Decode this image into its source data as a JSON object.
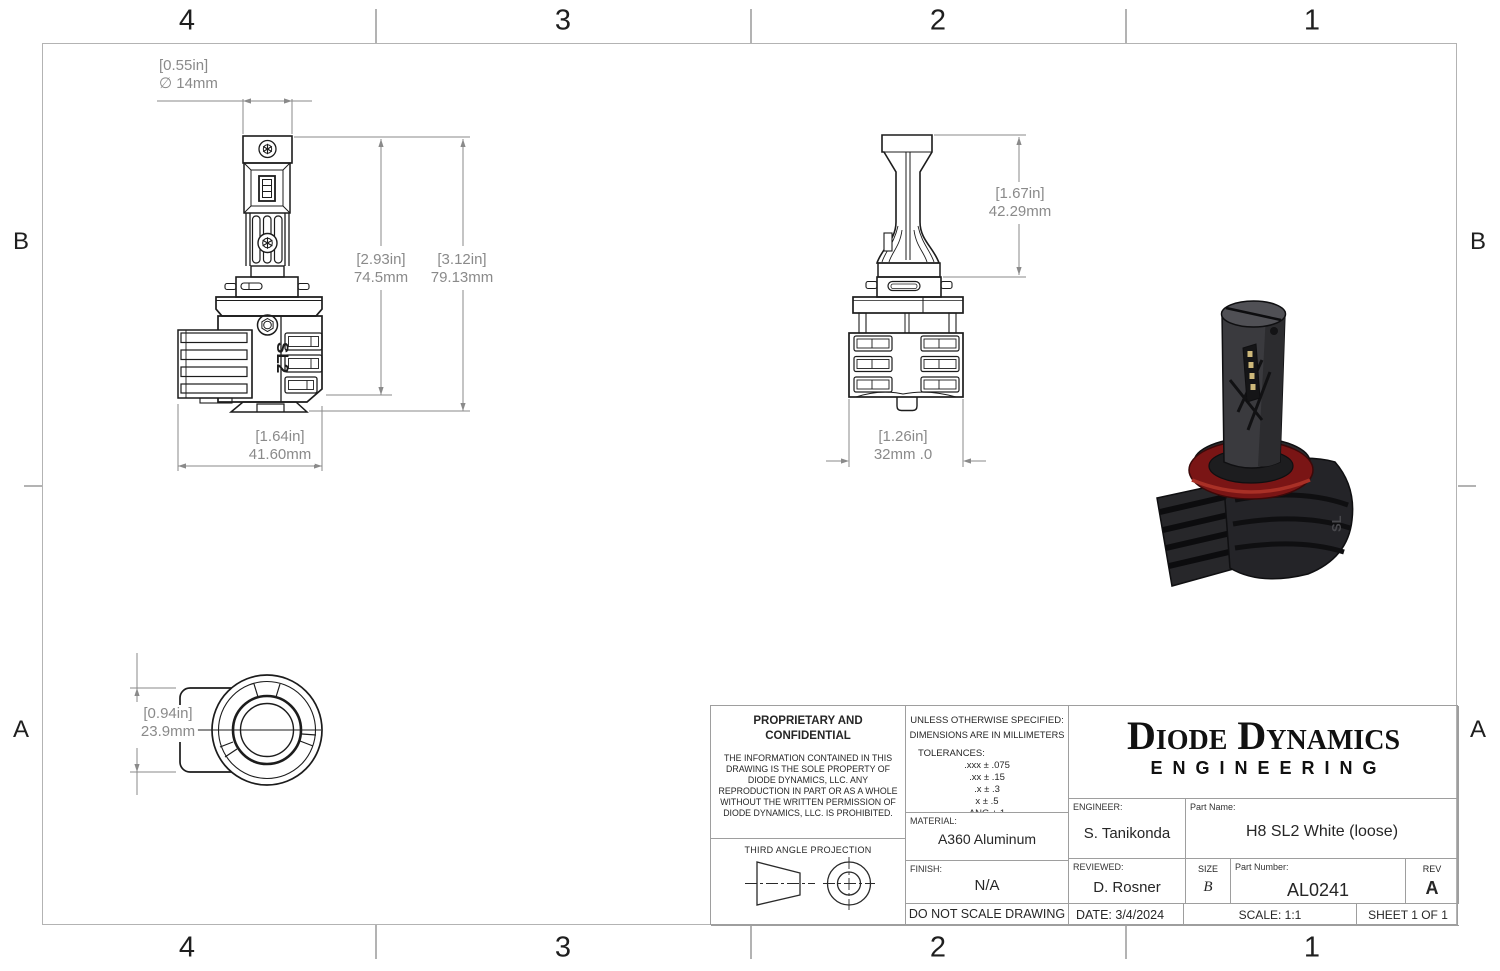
{
  "zones": {
    "top": [
      "4",
      "3",
      "2",
      "1"
    ],
    "bottom": [
      "4",
      "3",
      "2",
      "1"
    ],
    "left": [
      "B",
      "A"
    ],
    "right": [
      "B",
      "A"
    ]
  },
  "dims": {
    "cap_dia": {
      "in": "[0.55in]",
      "mm": "∅ 14mm"
    },
    "body_h": {
      "in": "[2.93in]",
      "mm": "74.5mm"
    },
    "total_h": {
      "in": "[3.12in]",
      "mm": "79.13mm"
    },
    "body_w": {
      "in": "[1.64in]",
      "mm": "41.60mm"
    },
    "side_h": {
      "in": "[1.67in]",
      "mm": "42.29mm"
    },
    "side_w": {
      "in": "[1.26in]",
      "mm": "32mm .0"
    },
    "base_h": {
      "in": "[0.94in]",
      "mm": "23.9mm"
    }
  },
  "views": {
    "front_logo": "SL2",
    "iso_logo": "SL"
  },
  "colors": {
    "iso_red_ring": "#7a1515",
    "iso_body": "#3a3a3e",
    "drawing_line": "#1c1c1c",
    "dimension_gray": "#8a8a8a",
    "border_gray": "#b3b3b3"
  },
  "title_block": {
    "proprietary": {
      "title": "PROPRIETARY AND CONFIDENTIAL",
      "body": "THE INFORMATION CONTAINED IN THIS DRAWING IS THE SOLE PROPERTY OF DIODE DYNAMICS, LLC.  ANY REPRODUCTION IN PART OR AS A WHOLE WITHOUT THE WRITTEN PERMISSION OF DIODE DYNAMICS, LLC. IS PROHIBITED."
    },
    "third_angle": {
      "label": "THIRD ANGLE PROJECTION"
    },
    "tolerances": {
      "line1": "UNLESS OTHERWISE SPECIFIED:",
      "line2": "DIMENSIONS ARE IN MILLIMETERS",
      "label": "TOLERANCES:",
      "items": [
        ".xxx ± .075",
        ".xx ± .15",
        ".x ± .3",
        "x ± .5",
        "ANG ± 1"
      ]
    },
    "material": {
      "label": "MATERIAL:",
      "value": "A360 Aluminum"
    },
    "finish": {
      "label": "FINISH:",
      "value": "N/A"
    },
    "do_not_scale": "DO NOT SCALE DRAWING",
    "logo": {
      "line1": "Diode Dynamics",
      "line2": "ENGINEERING"
    },
    "engineer": {
      "label": "ENGINEER:",
      "value": "S. Tanikonda"
    },
    "part_name": {
      "label": "Part Name:",
      "value": "H8 SL2 White (loose)"
    },
    "reviewed": {
      "label": "REVIEWED:",
      "value": "D. Rosner"
    },
    "size": {
      "label": "SIZE",
      "value": "B"
    },
    "part_number": {
      "label": "Part Number:",
      "value": "AL0241"
    },
    "rev": {
      "label": "REV",
      "value": "A"
    },
    "date": {
      "label": "DATE:",
      "value": "3/4/2024"
    },
    "scale": "SCALE: 1:1",
    "sheet": "SHEET 1 OF 1"
  }
}
